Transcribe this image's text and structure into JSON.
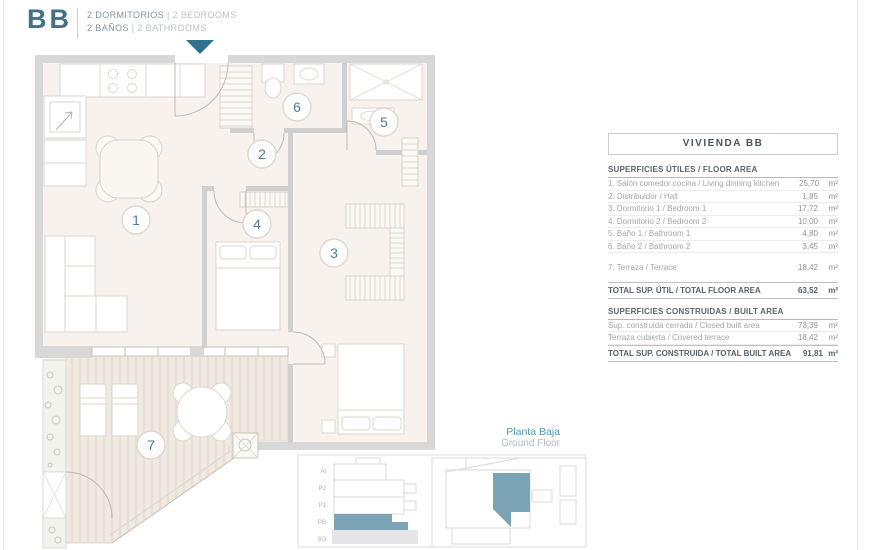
{
  "header": {
    "unit_code": "BB",
    "line1": {
      "primary": "2 DORMITORIOS",
      "secondary": "| 2 BEDROOMS"
    },
    "line2": {
      "primary": "2 BAÑOS",
      "secondary": "| 2 BATHROOMS"
    }
  },
  "plan": {
    "rooms": [
      "1",
      "2",
      "3",
      "4",
      "5",
      "6",
      "7"
    ]
  },
  "table": {
    "title": "VIVIENDA BB",
    "useful": {
      "header": "SUPERFICIES ÚTILES / FLOOR AREA",
      "rows": [
        {
          "label": "1. Salón comedor cocina / Living dinning kitchen",
          "value": "25,70",
          "unit": "m²"
        },
        {
          "label": "2. Distribuidor / Hall",
          "value": "1,85",
          "unit": "m²"
        },
        {
          "label": "3. Dormitorio 1 / Bedroom 1",
          "value": "17,72",
          "unit": "m²"
        },
        {
          "label": "4. Dormitorio 2 / Bedroom 2",
          "value": "10,00",
          "unit": "m²"
        },
        {
          "label": "5. Baño 1 / Bathroom 1",
          "value": "4,80",
          "unit": "m²"
        },
        {
          "label": "6. Baño 2 / Bathroom 2",
          "value": "3,45",
          "unit": "m²"
        }
      ],
      "terrace_row": {
        "label": "7. Terraza / Terrace",
        "value": "18,42",
        "unit": "m²"
      },
      "total": {
        "label": "TOTAL SUP. ÚTIL / TOTAL FLOOR AREA",
        "value": "63,52",
        "unit": "m²"
      }
    },
    "built": {
      "header": "SUPERFICIES CONSTRUIDAS / BUILT AREA",
      "rows": [
        {
          "label": "Sup. construida cerrada / Closed built area",
          "value": "73,39",
          "unit": "m²"
        },
        {
          "label": "Terraza cubierta / Covered terrace",
          "value": "18,42",
          "unit": "m²"
        }
      ],
      "total": {
        "label": "TOTAL SUP. CONSTRUIDA / TOTAL BUILT AREA",
        "value": "91,81",
        "unit": "m²"
      }
    }
  },
  "floor_caption": {
    "es": "Planta Baja",
    "en": "Ground Floor"
  },
  "site_plan": {
    "levels": [
      "At",
      "P2",
      "P1",
      "PB",
      "SO"
    ]
  },
  "colors": {
    "accent": "#2e7090",
    "accent_fill": "#7ba4b6",
    "wall": "#d8d8d8",
    "floor": "#f7f2ed"
  }
}
